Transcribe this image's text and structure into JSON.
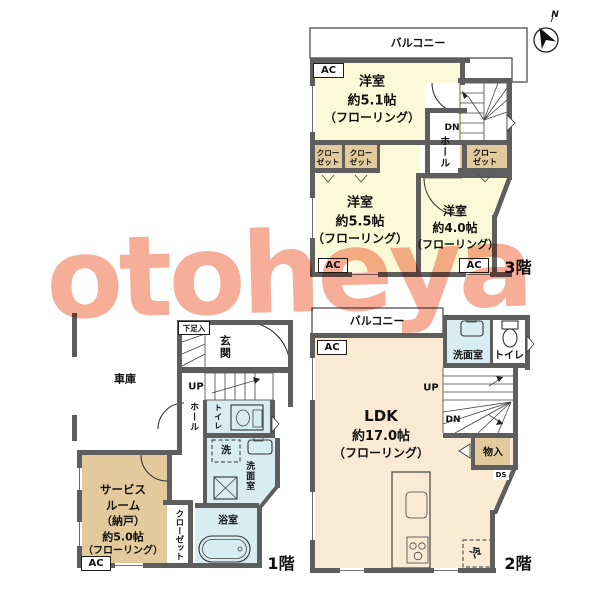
{
  "colors": {
    "room_yellow": "#FBFAD8",
    "ldk_cream": "#FAEAD3",
    "wet_blue": "#D8EDF2",
    "closet_tan": "#E2CA9C",
    "wall_gray": "#5E5E5E",
    "watermark_salmon": "#F59A7E"
  },
  "watermark_text": "otoheya",
  "compass": {
    "north": "N"
  },
  "f3": {
    "balcony": "バルコニー",
    "ac": "AC",
    "dn": "DN",
    "hall": "ホール",
    "closet2": [
      "クロー",
      "ゼット"
    ],
    "room51": [
      "洋室",
      "約5.1帖",
      "（フローリング）"
    ],
    "room55": [
      "洋室",
      "約5.5帖",
      "（フローリング）"
    ],
    "room40": [
      "洋室",
      "約4.0帖",
      "（フローリング）"
    ],
    "floor_label": "3階"
  },
  "f2": {
    "balcony": "バルコニー",
    "ac": "AC",
    "up": "UP",
    "dn": "DN",
    "washroom": "洗面室",
    "toilet": "トイレ",
    "storage": "物入",
    "ds": "DS",
    "fridge": "冷",
    "ldk": [
      "LDK",
      "約17.0帖",
      "（フローリング）"
    ],
    "floor_label": "2階"
  },
  "f1": {
    "garage": "車庫",
    "shoebox": "下足入",
    "entrance": "玄関",
    "up": "UP",
    "hall": "ホール",
    "toilet": "トイレ",
    "washer": "洗",
    "washroom": "洗面室",
    "bath": "浴室",
    "service": [
      "サービス",
      "ルーム",
      "（納戸）",
      "約5.0帖",
      "（フローリング）"
    ],
    "closet": "クローゼット",
    "ac": "AC",
    "floor_label": "1階"
  }
}
